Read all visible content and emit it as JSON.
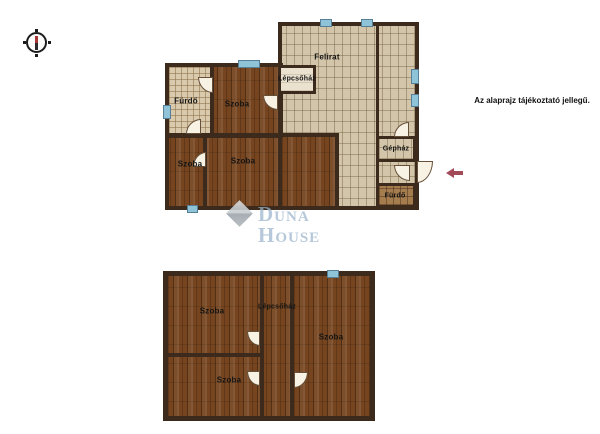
{
  "disclaimer": "Az alaprajz tájékoztató jellegű.",
  "watermark": {
    "brand": "Duna House"
  },
  "upper_floor": {
    "rooms": {
      "attic": "Felirat",
      "staircase": "Lépcsőház",
      "bathroom_left": "Fürdő",
      "room_top": "Szoba",
      "room_bottom_left": "Szoba",
      "room_bottom_main": "Szoba",
      "machine_room": "Gépház",
      "bathroom_right": "Fürdő"
    }
  },
  "lower_floor": {
    "rooms": {
      "room_top_left": "Szoba",
      "staircase": "Lépcsőház",
      "room_right": "Szoba",
      "room_bottom_left": "Szoba"
    }
  },
  "colors": {
    "wall": "#3c2b1d",
    "wood_floor": "#76451f",
    "tile_floor": "#d3c5aa",
    "window_marker": "#8fc3d8",
    "entrance_arrow": "#a34a58",
    "watermark_text": "#9ab4cb"
  }
}
